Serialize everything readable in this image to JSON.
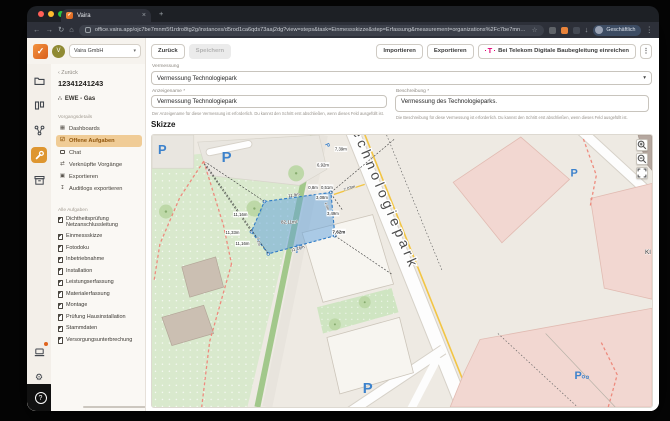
{
  "window": {
    "tab": "Vaira",
    "url": "office.vaira.app/ojc7be7mnm5f1rdro8tg2g/instances/d5rod1ca6qds73aaj2dg?view=steps&task=Einmessskizze&step=Erfassung&measurement=organizations%2Fc7be7mnm5f1rdro8tg2g%2Finsta...",
    "profile": "Geschäftlich"
  },
  "icons": {
    "check": "✓",
    "chevron_down": "▾",
    "back_arrow": "←",
    "forward_arrow": "→",
    "reload": "↻",
    "home": "⌂",
    "close": "×",
    "plus": "+",
    "star": "☆",
    "kebab": "⋮",
    "download": "↓",
    "back_chevron": "‹",
    "question": "?",
    "gear": "⚙",
    "dashboards": "▦",
    "tasks": "☑",
    "chat": "🗨",
    "link": "⇄",
    "export": "▣",
    "audit": "↧",
    "provider": "∴",
    "telekom_t": "T"
  },
  "sidebar": {
    "org": "Vaira GmbH",
    "avatar_initial": "V",
    "back": "Zurück",
    "process_id": "12341241243",
    "provider": "EWE - Gas",
    "section_details": "Vorgangsdetails",
    "detail_items": [
      "Dashboards",
      "Offene Aufgaben",
      "Chat",
      "Verknüpfte Vorgänge",
      "Exportieren",
      "Auditlogs exportieren"
    ],
    "section_tasks": "Alle Aufgaben",
    "tasks": [
      "Dichtheitsprüfung Netzanschlussleitung",
      "Einmessskizze",
      "Fotodoku",
      "Inbetriebnahme",
      "Installation",
      "Leistungserfassung",
      "Materialerfassung",
      "Montage",
      "Prüfung Hausinstallation",
      "Stammdaten",
      "Versorgungsunterbrechung"
    ]
  },
  "toolbar": {
    "back": "Zurück",
    "save": "Speichern",
    "import": "Importieren",
    "export": "Exportieren",
    "telekom": "Bei Telekom Digitale Baubegleitung einreichen"
  },
  "form": {
    "vermessung_label": "Vermessung",
    "vermessung_value": "Vermessung Technologiepark",
    "anzeigename_label": "Anzeigename *",
    "anzeigename_value": "Vermessung Technologiepark",
    "anzeigename_help": "Der Anzeigename für diese Vermessung ist erforderlich. Du kannst den Schritt erst abschließen, wenn dieses Feld ausgefüllt ist.",
    "beschreibung_label": "Beschreibung *",
    "beschreibung_value": "Vermessung des Technologieparks.",
    "beschreibung_help": "Die Beschreibung für diese Vermessung ist erforderlich. Du kannst den Schritt erst abschließen, wenn dieses Feld ausgefüllt ist."
  },
  "sketch": {
    "title": "Skizze",
    "street": "Technologiepark",
    "area": "82,11m²",
    "place": "Kl",
    "parking": "P",
    "measurements": {
      "m1": "7,39m",
      "m2": "6,92m",
      "m3": "0,8m",
      "m4": "0,51m",
      "m5": "3,08m",
      "m6": "7,03m",
      "m7": "1,0m",
      "m8": "3,49m",
      "m9": "7,62m",
      "m10": "11,16m",
      "m11": "11,33m",
      "m12": "11,16m",
      "m13": "11,9m",
      "m14": "11,16m",
      "m15": "7,1m"
    }
  }
}
